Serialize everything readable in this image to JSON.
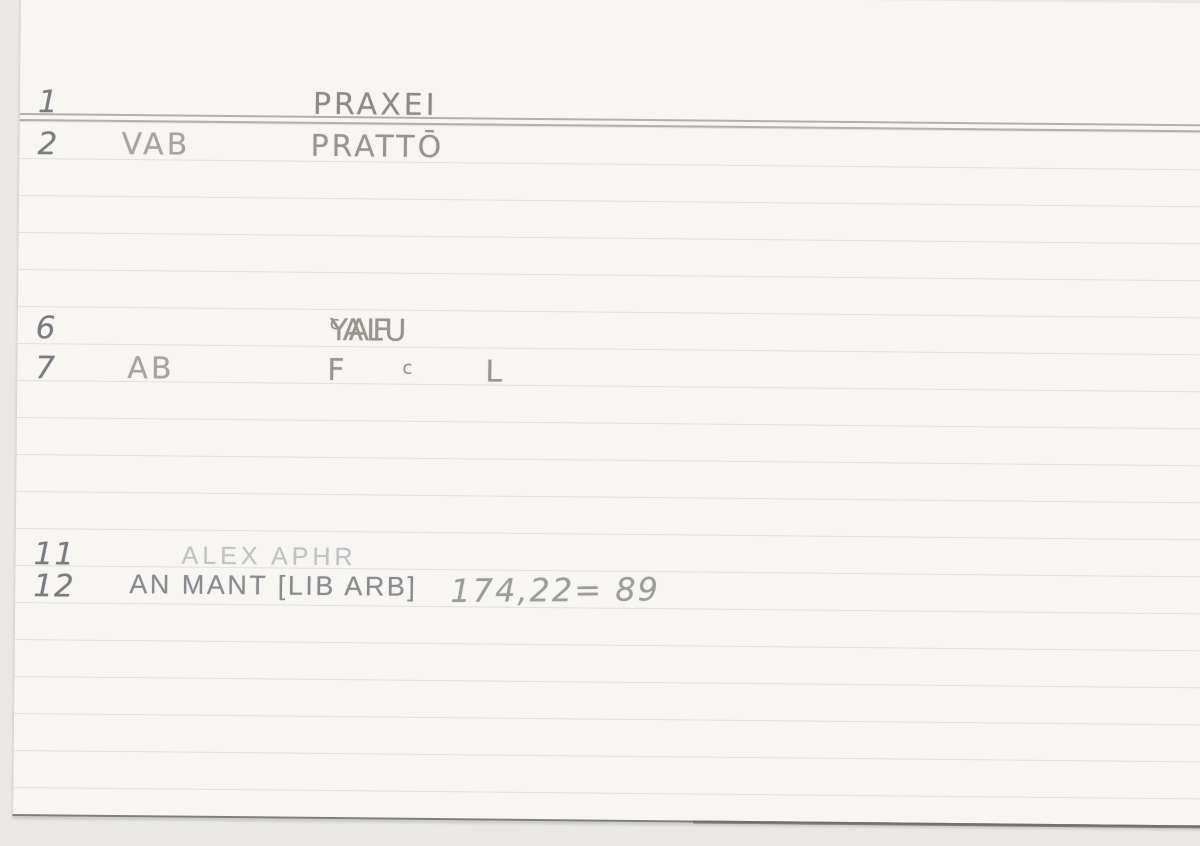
{
  "document_type": "ruled index card, scanned",
  "colors": {
    "background": "#e9e8e5",
    "card": "#f7f6f3",
    "rule_faint": "#c9c7c2",
    "rule_dark": "#a5a39f",
    "bottom_edge": "#807e7a",
    "pencil_number": "#7c7b81",
    "pencil_text": "#97958f",
    "stamp_light": "#c2c2c4",
    "stamp_dark": "#8a8a8f"
  },
  "entries": [
    {
      "number": "1",
      "headword": "PRAXEI"
    },
    {
      "number": "2",
      "abbr": "VAB",
      "headword": "PRATTŌ"
    },
    {
      "number": "6",
      "headword_pre": "YAF",
      "headword_sup": "c",
      "headword_post": "ALU"
    },
    {
      "number": "7",
      "abbr": "AB",
      "col_f": "F",
      "col_sup": "c",
      "col_l": "L"
    },
    {
      "number": "11",
      "stamp": "ALEX APHR"
    },
    {
      "number": "12",
      "stamp": "AN MANT [LIB ARB]",
      "reference": "174,22= 89"
    }
  ]
}
